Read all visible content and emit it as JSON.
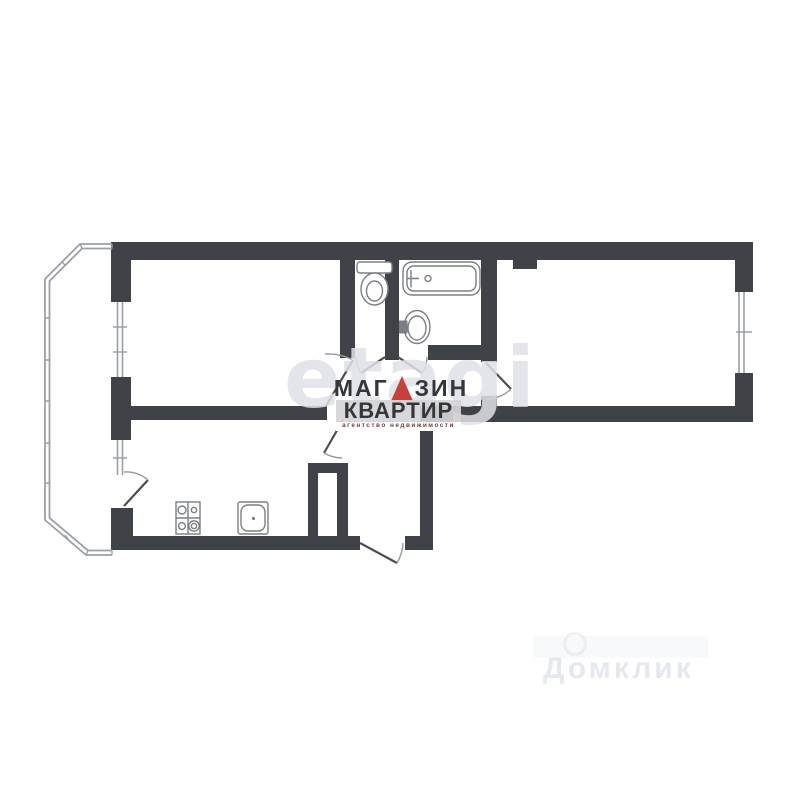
{
  "image": {
    "type": "apartment-floor-plan",
    "width": 800,
    "height": 800
  },
  "colors": {
    "bg": "#ffffff",
    "wall": "#3f4246",
    "glazing": "#9ba0a6",
    "fixture": "#7b7f84",
    "leaf": "#4a4d52",
    "arc": "#9599a0",
    "logo-text": "#33363b",
    "logo-triangle": "#c6413c",
    "logo-band": "rgba(213,213,215,0.92)",
    "logo-tagline": "#7c3a31",
    "wm-site": "rgba(223,225,231,0.85)",
    "wm-corner": "rgba(203,211,223,0.5)"
  },
  "brand": {
    "name_part1": "МАГ",
    "name_part2": "ЗИН",
    "name_line2": "КВАРТИР",
    "tagline": "агентство недвижимости",
    "triangle_icon": "red-triangle-letter-A"
  },
  "watermarks": {
    "center_site": "etagi",
    "corner_text": "Домклик"
  },
  "fixtures": [
    "toilet",
    "bathtub",
    "wash-basin",
    "gas-stove",
    "kitchen-sink"
  ]
}
